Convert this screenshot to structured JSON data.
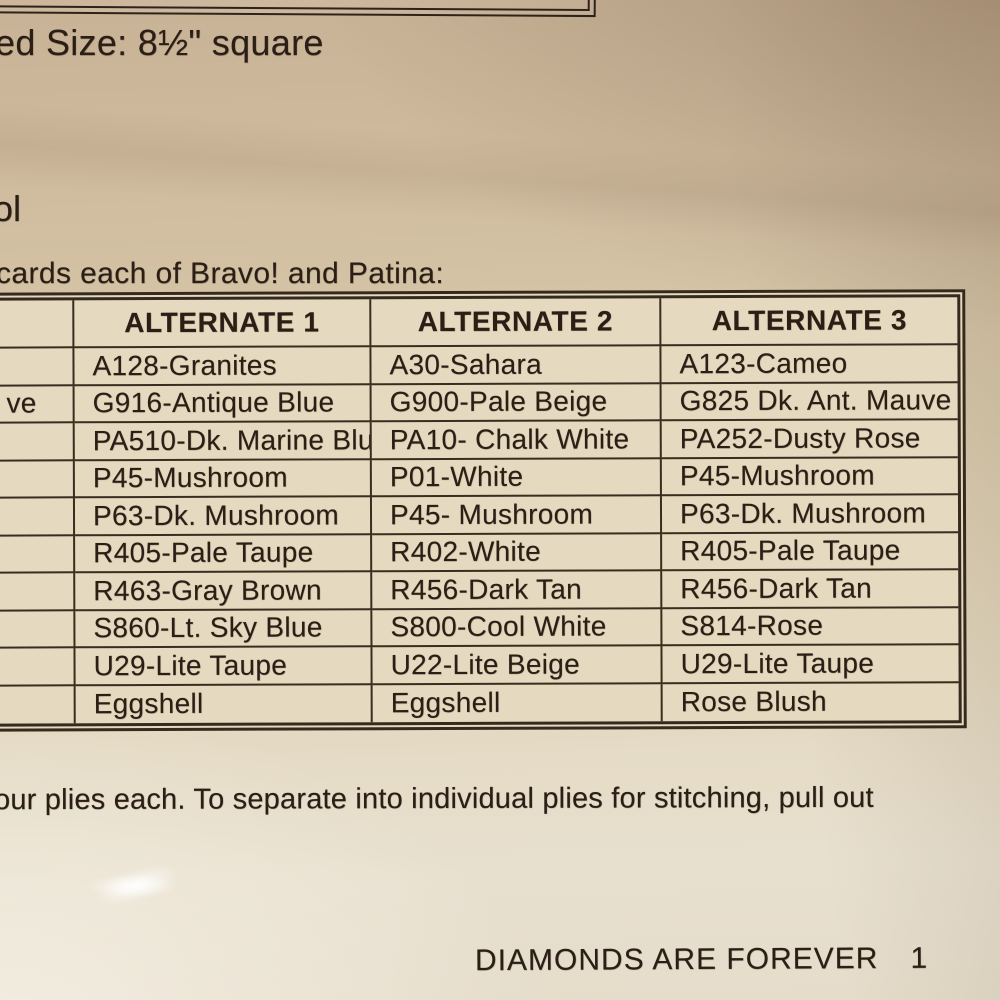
{
  "page": {
    "size_fragment": "ed Size: 8½\" square",
    "left_fragment": "ol",
    "intro_fragment": "cards each of Bravo! and Patina:",
    "table": {
      "headers": [
        "",
        "ALTERNATE 1",
        "ALTERNATE 2",
        "ALTERNATE 3"
      ],
      "rows": [
        [
          "",
          "A128-Granites",
          "A30-Sahara",
          "A123-Cameo"
        ],
        [
          "ve",
          "G916-Antique Blue",
          "G900-Pale Beige",
          "G825 Dk. Ant. Mauve"
        ],
        [
          "",
          "PA510-Dk. Marine Blue",
          "PA10- Chalk White",
          "PA252-Dusty Rose"
        ],
        [
          "",
          "P45-Mushroom",
          "P01-White",
          "P45-Mushroom"
        ],
        [
          "",
          "P63-Dk. Mushroom",
          "P45- Mushroom",
          "P63-Dk. Mushroom"
        ],
        [
          "",
          "R405-Pale Taupe",
          "R402-White",
          "R405-Pale Taupe"
        ],
        [
          "",
          "R463-Gray Brown",
          "R456-Dark Tan",
          "R456-Dark Tan"
        ],
        [
          "",
          "S860-Lt. Sky Blue",
          "S800-Cool White",
          "S814-Rose"
        ],
        [
          "",
          "U29-Lite Taupe",
          "U22-Lite Beige",
          "U29-Lite Taupe"
        ],
        [
          "",
          "Eggshell",
          "Eggshell",
          "Rose Blush"
        ]
      ]
    },
    "plies_fragment": "our plies each. To separate into individual plies for stitching, pull out",
    "footer": {
      "title": "DIAMONDS ARE FOREVER",
      "page_number": "1"
    }
  },
  "colors": {
    "ink": "#2a1e15",
    "table_border": "#3a2c1f",
    "cell_background": "#e5dabf",
    "paper_dark": "#c8b296",
    "paper_light": "#e8e0cf"
  }
}
